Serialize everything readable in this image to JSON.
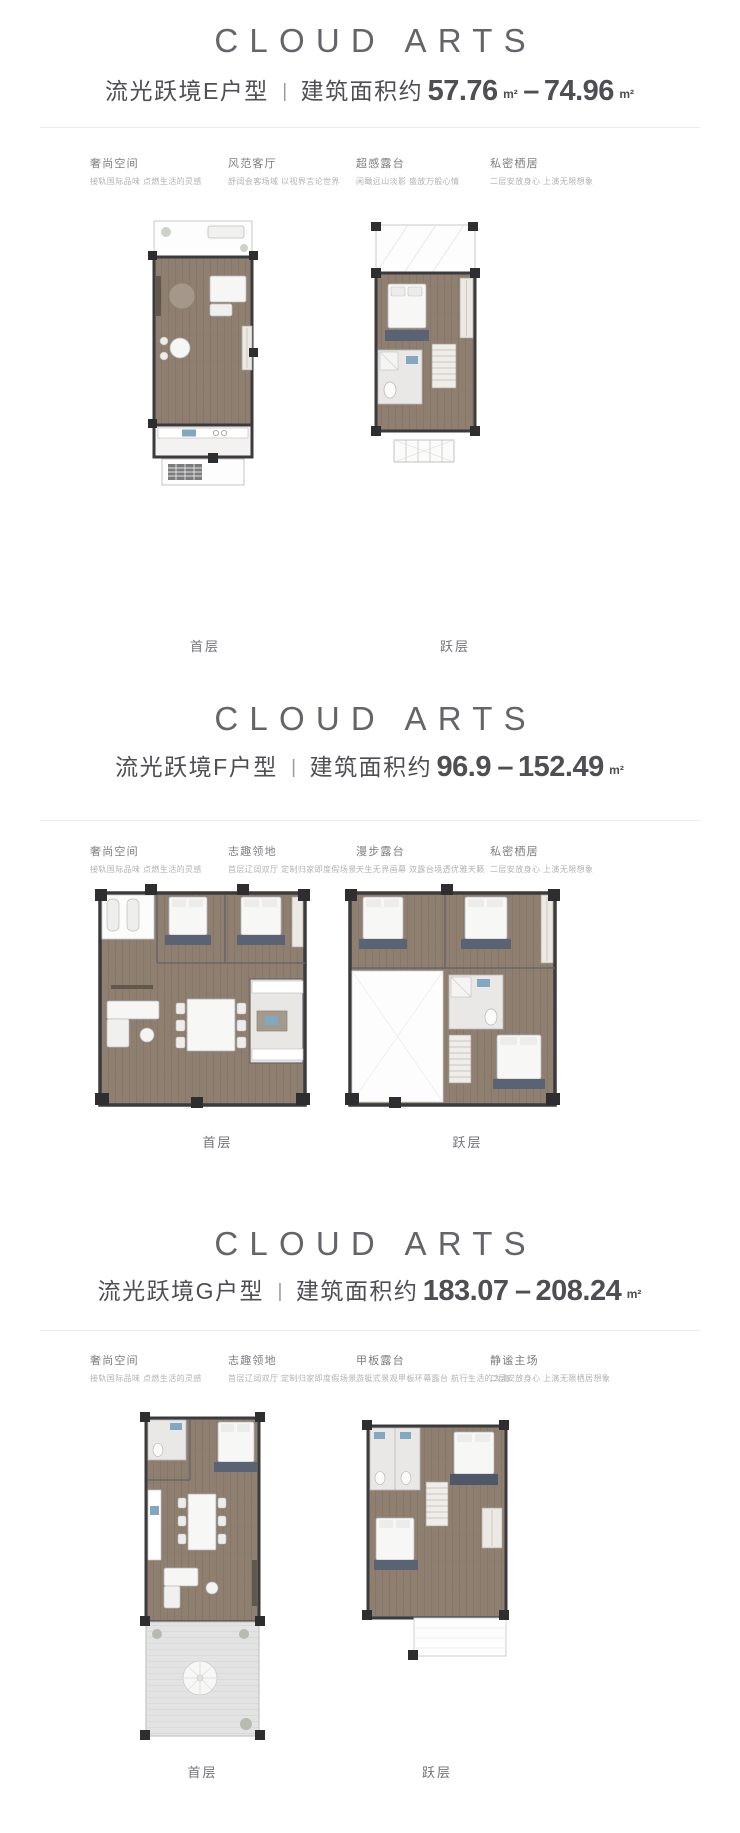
{
  "colors": {
    "background": "#ffffff",
    "brand_grey": "#64646a",
    "title_grey": "#4e4e53",
    "feature_title_grey": "#7d7d83",
    "feature_desc_grey": "#b2b2b6",
    "divider_grey": "#ebebee",
    "plan_wood": "#8e7f71",
    "plan_wall": "#2e2e30",
    "plan_rug_navy": "#5a6373",
    "plan_fixture_blue": "#84a7c1",
    "plan_deck_grey": "#e3e3e4"
  },
  "sections": [
    {
      "logo": "CLOUD ARTS",
      "title": "流光跃境E户型",
      "separator": "|",
      "area_prefix": "建筑面积约",
      "area_min": "57.76",
      "unit_min": "m²",
      "area_dash": "–",
      "area_max": "74.96",
      "unit_max": "m²",
      "features": [
        {
          "title": "奢尚空间",
          "desc": "接轨国际品味 点燃生活的灵感"
        },
        {
          "title": "风范客厅",
          "desc": "舒阔会客场域 以视界言论世界"
        },
        {
          "title": "超感露台",
          "desc": "闲瞰远山淡影 盛放万般心情"
        },
        {
          "title": "私密栖居",
          "desc": "二层安放身心 上演无限想象"
        }
      ],
      "plans": [
        {
          "label": "首层"
        },
        {
          "label": "跃层"
        }
      ]
    },
    {
      "logo": "CLOUD ARTS",
      "title": "流光跃境F户型",
      "separator": "|",
      "area_prefix": "建筑面积约",
      "area_min": "96.9",
      "unit_min": "",
      "area_dash": "–",
      "area_max": "152.49",
      "unit_max": "m²",
      "features": [
        {
          "title": "奢尚空间",
          "desc": "接轨国际品味 点燃生活的灵感"
        },
        {
          "title": "志趣领地",
          "desc": "首层辽阔双厅 定制归家即度假场景"
        },
        {
          "title": "漫步露台",
          "desc": "天生无界画幕 双露台境透优雅天籁"
        },
        {
          "title": "私密栖居",
          "desc": "二层安放身心 上演无限想象"
        }
      ],
      "plans": [
        {
          "label": "首层"
        },
        {
          "label": "跃层"
        }
      ]
    },
    {
      "logo": "CLOUD ARTS",
      "title": "流光跃境G户型",
      "separator": "|",
      "area_prefix": "建筑面积约",
      "area_min": "183.07",
      "unit_min": "",
      "area_dash": "–",
      "area_max": "208.24",
      "unit_max": "m²",
      "features": [
        {
          "title": "奢尚空间",
          "desc": "接轨国际品味 点燃生活的灵感"
        },
        {
          "title": "志趣领地",
          "desc": "首层辽阔双厅 定制归家即度假场景"
        },
        {
          "title": "甲板露台",
          "desc": "游艇式景观甲板环幕露台 航行生活的大海"
        },
        {
          "title": "静谧主场",
          "desc": "二层安放身心 上演无限栖居想象"
        }
      ],
      "plans": [
        {
          "label": "首层"
        },
        {
          "label": "跃层"
        }
      ]
    }
  ]
}
